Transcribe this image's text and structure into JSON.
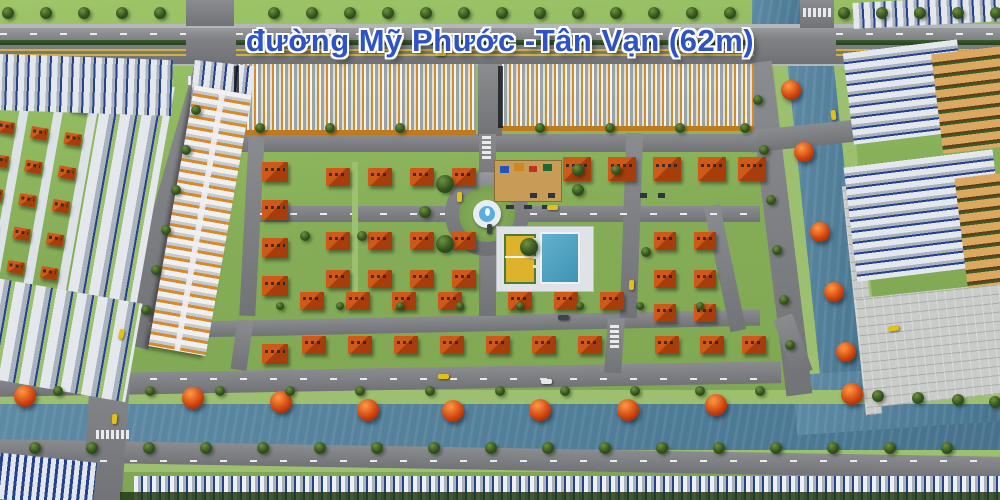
{
  "scene": {
    "road_label": "đường Mỹ Phước -Tân Vạn (62m)",
    "features": [
      "main road",
      "shophouse rows",
      "villa neighborhood",
      "roundabout fountain",
      "playground",
      "swimming pool",
      "tennis court",
      "canals with red trees",
      "tree-lined streets",
      "riverside promenade"
    ]
  },
  "palette": {
    "grass": "#85ad58",
    "grass_light": "#9dc070",
    "grass_dark": "#6d9546",
    "road": "#7b7d80",
    "road_light": "#8d8f92",
    "road_dark": "#5f6165",
    "sidewalk": "#b4b7ba",
    "median_hedge": "#24421c",
    "lane_yellow": "#d2b23c",
    "dash_white": "#e8eaec",
    "water": "#55819b",
    "water_deep": "#47718c",
    "roof_orange": "#a63d0b",
    "roof_orange_hi": "#cf5a17",
    "roof_white": "#e4e8ec",
    "roof_gray": "#aab3bd",
    "trim_blue": "#24418f",
    "shop_orange": "#d88a28",
    "shop_base": "#c07a1e",
    "tan_roof": "#dca75f",
    "tree_green_hi": "#6f913f",
    "tree_green": "#33531f",
    "tree_green_dark": "#1f3712",
    "tree_red_hi": "#ff9a45",
    "tree_red": "#d1450f",
    "tree_red_dark": "#7a1d05",
    "pool_blue": "#3f93b5",
    "deck_white": "#dfe3e7",
    "court_yellow": "#ddb32c",
    "court_green": "#4e7b33",
    "fountain_white": "#e9edf1",
    "fountain_blue": "#59aede",
    "car_yellow": "#e3c018",
    "car_white": "#e8e8e8",
    "car_gray": "#3f444a",
    "paver": "#c9ccc8",
    "playground_sand": "#c89b57",
    "label_blue": "#2d53c6"
  }
}
